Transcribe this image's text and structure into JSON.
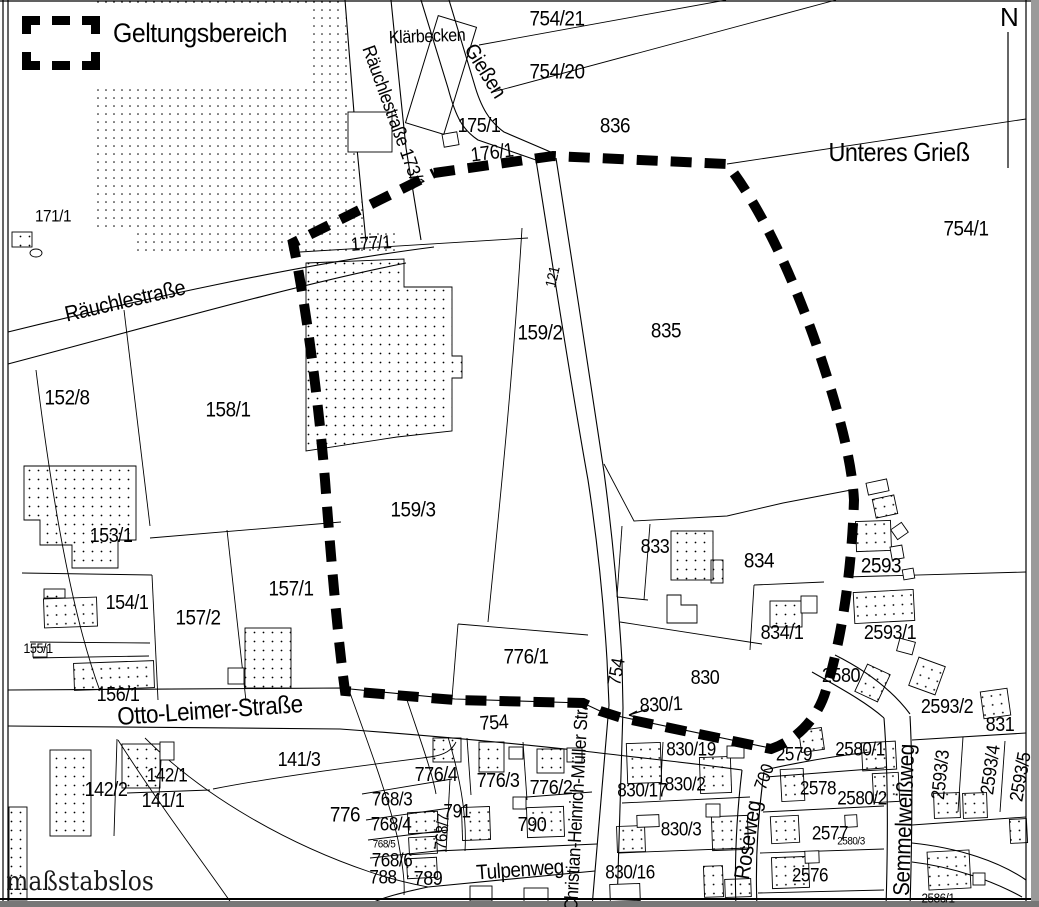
{
  "map": {
    "legend": {
      "symbol": "dashed-rectangle",
      "label": "Geltungsbereich"
    },
    "north_label": "N",
    "scale_note": "maßstabslos",
    "place_labels": [
      {
        "t": "Klärbecken",
        "x": 427,
        "y": 36,
        "r": -2,
        "s": 18
      },
      {
        "t": "Unteres Grieß",
        "x": 899,
        "y": 152,
        "r": 0,
        "s": 26
      },
      {
        "t": "maßstabslos",
        "x": 80,
        "y": 882,
        "r": 0,
        "s": 26,
        "f": "serif"
      }
    ],
    "street_labels": [
      {
        "t": "Räuchlestraße 173/1",
        "x": 393,
        "y": 117,
        "r": 70,
        "s": 19
      },
      {
        "t": "Gießen",
        "x": 485,
        "y": 71,
        "r": 58,
        "s": 21
      },
      {
        "t": "Räuchlestraße",
        "x": 125,
        "y": 301,
        "r": -13,
        "s": 22
      },
      {
        "t": "Otto-Leimer-Straße",
        "x": 210,
        "y": 711,
        "r": -4,
        "s": 25
      },
      {
        "t": "Christian-Heinrich-Müller Str.",
        "x": 577,
        "y": 809,
        "r": -87,
        "s": 19
      },
      {
        "t": "Roseweg",
        "x": 748,
        "y": 840,
        "r": -81,
        "s": 22
      },
      {
        "t": "Tulpenweg",
        "x": 520,
        "y": 870,
        "r": -4,
        "s": 21
      },
      {
        "t": "Semmelweißweg",
        "x": 904,
        "y": 820,
        "r": -88,
        "s": 23
      }
    ],
    "parcel_labels": [
      {
        "t": "754/21",
        "x": 557,
        "y": 19,
        "r": 0,
        "s": 21
      },
      {
        "t": "754/20",
        "x": 557,
        "y": 72,
        "r": 0,
        "s": 21
      },
      {
        "t": "836",
        "x": 615,
        "y": 126,
        "r": 0,
        "s": 21
      },
      {
        "t": "754/1",
        "x": 966,
        "y": 229,
        "r": 0,
        "s": 21
      },
      {
        "t": "171/1",
        "x": 53,
        "y": 216,
        "r": 0,
        "s": 17
      },
      {
        "t": "175/1",
        "x": 479,
        "y": 126,
        "r": 0,
        "s": 20
      },
      {
        "t": "176/1",
        "x": 492,
        "y": 153,
        "r": -7,
        "s": 20
      },
      {
        "t": "177/1",
        "x": 371,
        "y": 244,
        "r": -4,
        "s": 19
      },
      {
        "t": "159/2",
        "x": 540,
        "y": 333,
        "r": 0,
        "s": 21
      },
      {
        "t": "835",
        "x": 666,
        "y": 331,
        "r": 0,
        "s": 21
      },
      {
        "t": "121",
        "x": 553,
        "y": 277,
        "r": -77,
        "s": 15
      },
      {
        "t": "152/8",
        "x": 67,
        "y": 398,
        "r": 0,
        "s": 21
      },
      {
        "t": "158/1",
        "x": 228,
        "y": 410,
        "r": 0,
        "s": 21
      },
      {
        "t": "159/3",
        "x": 413,
        "y": 510,
        "r": 0,
        "s": 21
      },
      {
        "t": "153/1",
        "x": 111,
        "y": 536,
        "r": 0,
        "s": 20
      },
      {
        "t": "154/1",
        "x": 127,
        "y": 603,
        "r": 0,
        "s": 20
      },
      {
        "t": "157/2",
        "x": 198,
        "y": 618,
        "r": 0,
        "s": 21
      },
      {
        "t": "157/1",
        "x": 291,
        "y": 589,
        "r": 0,
        "s": 21
      },
      {
        "t": "155/1",
        "x": 38,
        "y": 648,
        "r": 0,
        "s": 14
      },
      {
        "t": "156/1",
        "x": 118,
        "y": 695,
        "r": 0,
        "s": 20
      },
      {
        "t": "833",
        "x": 655,
        "y": 547,
        "r": 0,
        "s": 20
      },
      {
        "t": "834",
        "x": 759,
        "y": 561,
        "r": 0,
        "s": 21
      },
      {
        "t": "2593",
        "x": 881,
        "y": 566,
        "r": 0,
        "s": 21
      },
      {
        "t": "834/1",
        "x": 782,
        "y": 633,
        "r": 0,
        "s": 20
      },
      {
        "t": "2593/1",
        "x": 890,
        "y": 633,
        "r": 0,
        "s": 20
      },
      {
        "t": "776/1",
        "x": 526,
        "y": 657,
        "r": 0,
        "s": 21
      },
      {
        "t": "754",
        "x": 617,
        "y": 672,
        "r": -80,
        "s": 19
      },
      {
        "t": "830",
        "x": 705,
        "y": 678,
        "r": 0,
        "s": 20
      },
      {
        "t": "2580",
        "x": 841,
        "y": 676,
        "r": 0,
        "s": 20
      },
      {
        "t": "830/1",
        "x": 661,
        "y": 705,
        "r": -3,
        "s": 20
      },
      {
        "t": "754",
        "x": 494,
        "y": 723,
        "r": -4,
        "s": 20
      },
      {
        "t": "2593/2",
        "x": 947,
        "y": 707,
        "r": 0,
        "s": 20
      },
      {
        "t": "831",
        "x": 1000,
        "y": 725,
        "r": 0,
        "s": 20
      },
      {
        "t": "141/3",
        "x": 299,
        "y": 760,
        "r": 0,
        "s": 20
      },
      {
        "t": "142/2",
        "x": 106,
        "y": 790,
        "r": 0,
        "s": 20
      },
      {
        "t": "142/1",
        "x": 167,
        "y": 776,
        "r": 0,
        "s": 19
      },
      {
        "t": "141/1",
        "x": 163,
        "y": 801,
        "r": 0,
        "s": 20
      },
      {
        "t": "776",
        "x": 345,
        "y": 815,
        "r": 0,
        "s": 21
      },
      {
        "t": "776/4",
        "x": 436,
        "y": 775,
        "r": 0,
        "s": 20
      },
      {
        "t": "776/3",
        "x": 498,
        "y": 781,
        "r": 0,
        "s": 20
      },
      {
        "t": "776/2",
        "x": 551,
        "y": 788,
        "r": 0,
        "s": 20
      },
      {
        "t": "768/3",
        "x": 392,
        "y": 800,
        "r": 0,
        "s": 19
      },
      {
        "t": "768/4",
        "x": 391,
        "y": 825,
        "r": 0,
        "s": 19
      },
      {
        "t": "768/5",
        "x": 384,
        "y": 845,
        "r": 0,
        "s": 11
      },
      {
        "t": "768/6",
        "x": 392,
        "y": 861,
        "r": 0,
        "s": 19
      },
      {
        "t": "768/7",
        "x": 442,
        "y": 832,
        "r": -85,
        "s": 17
      },
      {
        "t": "788",
        "x": 383,
        "y": 878,
        "r": 0,
        "s": 19
      },
      {
        "t": "789",
        "x": 428,
        "y": 879,
        "r": 0,
        "s": 20
      },
      {
        "t": "790",
        "x": 532,
        "y": 825,
        "r": 0,
        "s": 20
      },
      {
        "t": "791",
        "x": 457,
        "y": 812,
        "r": 0,
        "s": 19
      },
      {
        "t": "830/19",
        "x": 691,
        "y": 750,
        "r": 0,
        "s": 19
      },
      {
        "t": "830/2",
        "x": 685,
        "y": 785,
        "r": 0,
        "s": 19
      },
      {
        "t": "830/17",
        "x": 642,
        "y": 791,
        "r": 0,
        "s": 19
      },
      {
        "t": "830/3",
        "x": 681,
        "y": 830,
        "r": 0,
        "s": 19
      },
      {
        "t": "830/16",
        "x": 630,
        "y": 873,
        "r": 0,
        "s": 19
      },
      {
        "t": "2579",
        "x": 794,
        "y": 755,
        "r": 0,
        "s": 19
      },
      {
        "t": "2578",
        "x": 818,
        "y": 789,
        "r": 0,
        "s": 19
      },
      {
        "t": "2577",
        "x": 830,
        "y": 834,
        "r": 0,
        "s": 19
      },
      {
        "t": "2576",
        "x": 810,
        "y": 876,
        "r": 0,
        "s": 19
      },
      {
        "t": "2580/1",
        "x": 860,
        "y": 750,
        "r": 0,
        "s": 19
      },
      {
        "t": "2580/2",
        "x": 862,
        "y": 799,
        "r": 0,
        "s": 19
      },
      {
        "t": "2580/3",
        "x": 851,
        "y": 842,
        "r": 0,
        "s": 11
      },
      {
        "t": "700",
        "x": 764,
        "y": 777,
        "r": -70,
        "s": 18
      },
      {
        "t": "2593/3",
        "x": 941,
        "y": 775,
        "r": -84,
        "s": 19
      },
      {
        "t": "2593/4",
        "x": 991,
        "y": 770,
        "r": -82,
        "s": 19
      },
      {
        "t": "2593/5",
        "x": 1021,
        "y": 777,
        "r": -80,
        "s": 19
      },
      {
        "t": "2586/1",
        "x": 938,
        "y": 898,
        "r": 0,
        "s": 13
      }
    ],
    "geometry": {
      "boundary_path": "M434,173 L553,156 L727,164 C763,210 800,290 828,380 C842,425 852,465 854,500 C852,565 843,635 826,690 C818,718 797,740 771,749 L622,718 L600,711 L583,703 L455,700 L345,691 C338,640 331,560 325,480 C318,395 305,300 293,243 L434,173",
      "road_paths": [
        "M345,0 L356,138 L366,242",
        "M391,0 L399,80 L406,148 L421,240",
        "M8,332 C130,302 300,264 434,247",
        "M8,364 C130,332 290,286 406,263",
        "M421,0 L448,88 C456,118 463,130 478,140 L536,160",
        "M449,0 L474,83 C481,108 490,122 504,132 L553,153",
        "M536,160 C552,260 570,380 588,480 C598,545 604,610 607,660 L609,705",
        "M556,158 C572,258 589,375 604,472 C613,540 619,610 622,662 L623,708",
        "M609,705 L592,907",
        "M623,708 L617,907",
        "M8,690 L340,688 L455,699 L583,703 L600,711 L622,717 L770,748",
        "M8,726 L340,729 C450,737 520,744 583,751 C650,759 700,764 742,770",
        "M742,770 C737,812 734,855 736,907",
        "M764,772 C758,815 755,858 757,907",
        "M764,770 C800,762 835,756 870,752",
        "M884,718 C888,770 888,840 886,907",
        "M910,716 C913,770 912,840 910,907",
        "M812,672 C840,688 866,702 884,718",
        "M835,655 C865,670 892,690 910,714",
        "M437,851 L597,844",
        "M428,887 L595,871",
        "M428,887 C400,893 380,898 368,905",
        "M912,740 L1026,733",
        "M912,843 C960,848 1000,862 1026,880",
        "M912,862 C955,867 995,882 1022,897"
      ],
      "parcel_line_paths": [
        "M479,45 L726,0",
        "M493,92 L836,0",
        "M727,164 L1026,119",
        "M300,252 L528,238",
        "M522,228 C512,390 498,520 488,622",
        "M458,624 L588,635",
        "M458,624 L452,698",
        "M124,310 L150,526",
        "M150,538 L341,522",
        "M227,530 L246,701",
        "M22,573 L152,575",
        "M30,642 L150,643",
        "M33,658 L149,656",
        "M36,370 C52,500 72,615 100,691",
        "M152,575 L158,700",
        "M604,464 L634,521 L727,516 L783,503 L851,490",
        "M622,526 L617,597",
        "M650,524 L644,600",
        "M617,597 L648,600",
        "M620,622 L762,644",
        "M754,585 L824,582",
        "M754,585 L750,650",
        "M845,577 L1026,572",
        "M766,777 L884,768",
        "M763,812 L884,806",
        "M760,853 L884,849",
        "M758,893 L884,890",
        "M963,737 L958,812",
        "M1005,741 L1000,812",
        "M912,825 L1026,817",
        "M117,739 L114,836",
        "M162,743 L159,795",
        "M127,793 L210,790",
        "M118,740 C160,806 200,858 234,907",
        "M145,738 C205,798 290,845 370,872 C400,882 418,885 428,887",
        "M213,789 C280,776 360,766 430,757 C445,755 452,750 456,742",
        "M448,737 C461,780 467,818 465,851",
        "M350,693 C370,748 389,800 398,840 C402,862 405,880 404,895",
        "M407,700 C421,742 432,772 436,794",
        "M362,794 L452,779",
        "M366,820 L450,808",
        "M368,840 L448,830",
        "M370,858 L446,850",
        "M450,779 L446,852",
        "M467,738 L471,795",
        "M523,742 L527,800",
        "M527,797 L592,792",
        "M663,742 L660,800",
        "M622,803 L750,797",
        "M618,853 L748,848"
      ],
      "stipple_region_paths": [
        "M97,0 L344,0 L352,95 L358,160 L364,228 L399,230 L399,253 L133,253 L133,230 L97,227 Z"
      ],
      "stippled_building_paths": [
        "M306,263 L404,259 L404,287 L452,287 L452,356 L462,356 L462,378 L452,378 L452,431 L397,437 L306,451 Z",
        "M24,466 L136,466 L136,540 L118,540 L118,568 L72,568 L72,545 L40,545 L40,520 L24,520 Z"
      ],
      "white_building_paths": [
        "M667,595 L681,595 L681,605 L697,605 L697,623 L667,623 Z"
      ],
      "stippled_buildings_xywhr": [
        [
          12,
          232,
          20,
          15,
          0
        ],
        [
          44,
          589,
          21,
          9,
          0
        ],
        [
          44,
          598,
          53,
          29,
          -2
        ],
        [
          74,
          662,
          80,
          27,
          -2
        ],
        [
          245,
          628,
          46,
          60,
          0
        ],
        [
          50,
          750,
          41,
          86,
          0
        ],
        [
          122,
          744,
          38,
          44,
          0
        ],
        [
          9,
          807,
          18,
          93,
          0
        ],
        [
          671,
          531,
          42,
          49,
          0
        ],
        [
          711,
          560,
          12,
          23,
          0
        ],
        [
          770,
          601,
          32,
          26,
          0
        ],
        [
          856,
          521,
          35,
          30,
          -2
        ],
        [
          854,
          591,
          60,
          31,
          -3
        ],
        [
          433,
          738,
          28,
          24,
          0
        ],
        [
          479,
          742,
          25,
          30,
          0
        ],
        [
          537,
          749,
          27,
          24,
          0
        ],
        [
          627,
          743,
          34,
          40,
          -2
        ],
        [
          700,
          757,
          31,
          36,
          -2
        ],
        [
          800,
          729,
          23,
          22,
          -8
        ],
        [
          781,
          769,
          23,
          32,
          -3
        ],
        [
          771,
          816,
          28,
          27,
          -3
        ],
        [
          772,
          857,
          37,
          31,
          -2
        ],
        [
          712,
          816,
          36,
          34,
          -2
        ],
        [
          617,
          826,
          28,
          26,
          -2
        ],
        [
          704,
          866,
          19,
          31,
          -2
        ],
        [
          725,
          879,
          26,
          18,
          -2
        ],
        [
          408,
          812,
          30,
          21,
          -3
        ],
        [
          409,
          837,
          28,
          17,
          -3
        ],
        [
          407,
          858,
          30,
          20,
          -3
        ],
        [
          462,
          807,
          28,
          33,
          -2
        ],
        [
          527,
          807,
          37,
          30,
          -2
        ],
        [
          860,
          668,
          25,
          30,
          25
        ],
        [
          913,
          661,
          28,
          30,
          20
        ],
        [
          982,
          690,
          27,
          27,
          -8
        ],
        [
          862,
          742,
          34,
          28,
          -3
        ],
        [
          934,
          793,
          26,
          25,
          -2
        ],
        [
          963,
          793,
          24,
          25,
          -2
        ],
        [
          1010,
          819,
          17,
          24,
          -3
        ],
        [
          928,
          851,
          42,
          38,
          -3
        ],
        [
          873,
          773,
          26,
          29,
          -3
        ],
        [
          874,
          497,
          22,
          19,
          -12
        ]
      ],
      "white_buildings_xywhr": [
        [
          348,
          112,
          44,
          40,
          0
        ],
        [
          443,
          133,
          15,
          13,
          -10
        ],
        [
          33,
          647,
          14,
          10,
          0
        ],
        [
          228,
          668,
          16,
          16,
          0
        ],
        [
          801,
          596,
          16,
          17,
          0
        ],
        [
          160,
          742,
          14,
          18,
          0
        ],
        [
          509,
          747,
          14,
          12,
          0
        ],
        [
          567,
          748,
          15,
          14,
          0
        ],
        [
          727,
          746,
          17,
          12,
          0
        ],
        [
          706,
          804,
          14,
          13,
          0
        ],
        [
          637,
          815,
          22,
          12,
          -2
        ],
        [
          805,
          851,
          14,
          12,
          -2
        ],
        [
          973,
          873,
          12,
          12,
          0
        ],
        [
          513,
          797,
          13,
          12,
          0
        ],
        [
          470,
          886,
          22,
          15,
          0
        ],
        [
          524,
          888,
          24,
          15,
          0
        ],
        [
          610,
          884,
          30,
          17,
          -2
        ],
        [
          867,
          481,
          21,
          12,
          -12
        ],
        [
          893,
          525,
          13,
          12,
          -35
        ],
        [
          891,
          546,
          12,
          13,
          -10
        ],
        [
          903,
          569,
          11,
          10,
          -10
        ],
        [
          898,
          640,
          16,
          13,
          15
        ],
        [
          845,
          815,
          12,
          12,
          -3
        ]
      ],
      "outline_rects_xywhr": [
        [
          421,
          19,
          40,
          112,
          17
        ]
      ],
      "ellipses_xyrr": [
        [
          36,
          253,
          6,
          4
        ]
      ],
      "north_line_path": "M1008,32 L1008,168",
      "leader_arrow_path": "M648,709 L629,715 M629,715 L637,711 M629,715 L638,718",
      "frame_line_paths": [
        "M3,0 L3,907",
        "M8,0 L8,907",
        "M1026,0 L1026,907",
        "M0,1 L1039,1",
        "M0,899 L1039,899"
      ],
      "edge_rects_xywhc": [
        [
          1031,
          0,
          8,
          907,
          "#9a9a9a"
        ],
        [
          0,
          901,
          1039,
          6,
          "#777777"
        ]
      ]
    },
    "colors": {
      "ink": "#000000",
      "paper": "#ffffff",
      "edge_gray": "#9a9a9a"
    }
  }
}
